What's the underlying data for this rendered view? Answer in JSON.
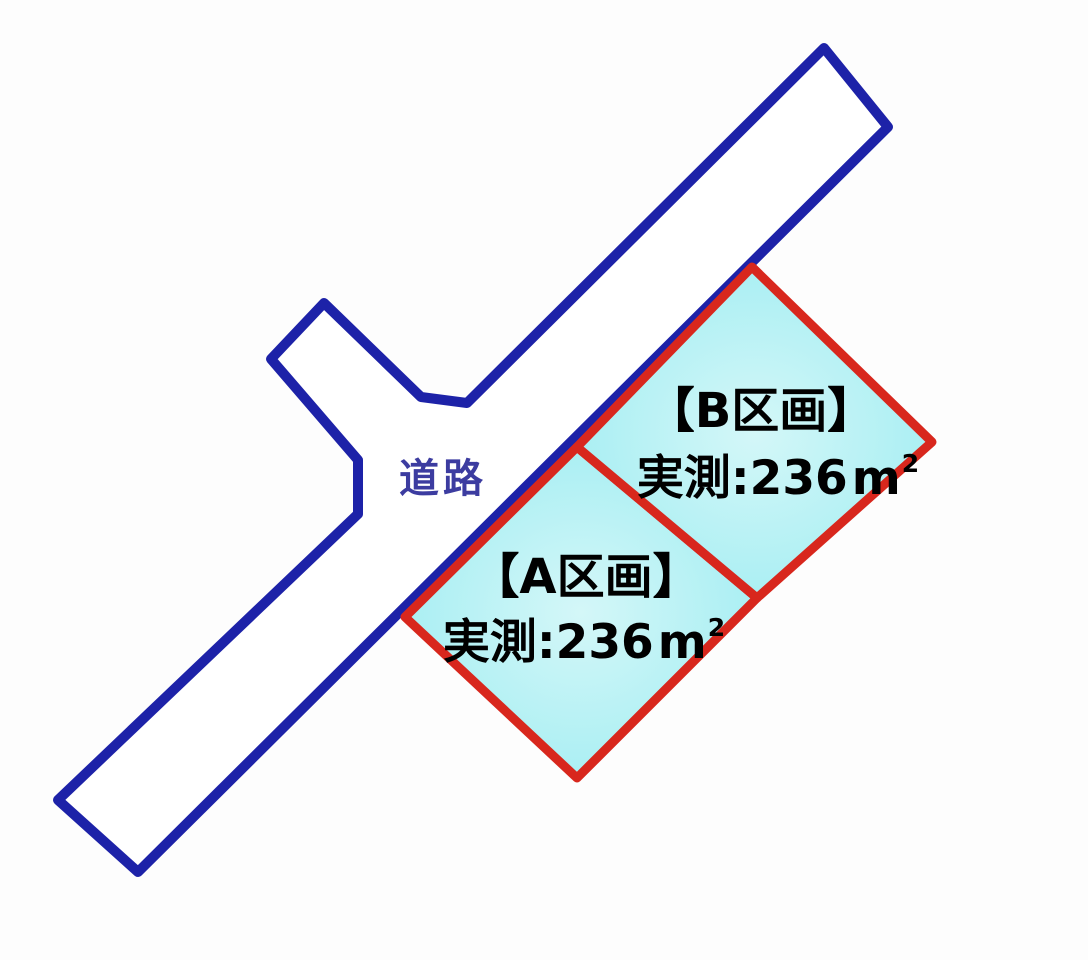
{
  "diagram": {
    "type": "land-plot-map",
    "colors": {
      "background": "#fdfdfd",
      "road_outline": "#1d22a8",
      "road_fill": "#ffffff",
      "road_label_color": "#3c3ca0",
      "plot_outline": "#d8271d",
      "plot_fill_center": "#d4f7f8",
      "plot_fill_edge": "#9becf1",
      "plot_text_color": "#000000"
    },
    "road": {
      "label": "道路"
    },
    "plots": {
      "a": {
        "label": "【A区画】",
        "area_prefix": "実測:236",
        "area_unit_base": "m",
        "area_unit_exponent": "2"
      },
      "b": {
        "label": "【B区画】",
        "area_prefix": "実測:236",
        "area_unit_base": "m",
        "area_unit_exponent": "2"
      }
    }
  }
}
